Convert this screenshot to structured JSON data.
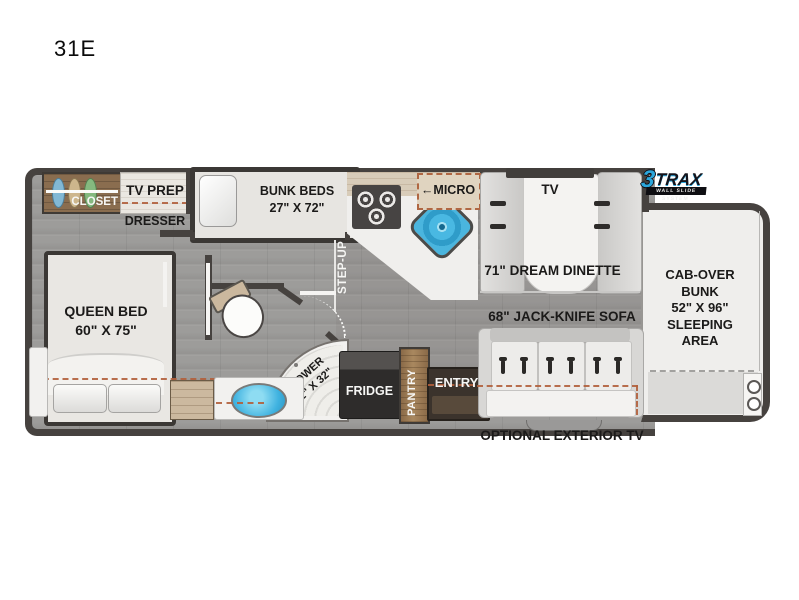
{
  "model": "31E",
  "logo": {
    "number": "3",
    "name": "TRAX",
    "tagline": "WALL SLIDE SYSTEM"
  },
  "labels": {
    "closet": "CLOSET",
    "tv_prep": "TV PREP",
    "dresser": "DRESSER",
    "bunk_line1": "BUNK BEDS",
    "bunk_line2": "27\" X 72\"",
    "micro_arrow": "←",
    "micro": "MICRO",
    "step_up": "STEP-UP",
    "dinette_tv": "TV",
    "dinette": "71\" DREAM DINETTE",
    "cab_over": "CAB-OVER\nBUNK\n52\" X 96\"\nSLEEPING\nAREA",
    "queen_line1": "QUEEN BED",
    "queen_line2": "60\" X 75\"",
    "shower_line1": "SHOWER",
    "shower_line2": "32\" X 32\"",
    "fridge": "FRIDGE",
    "pantry": "PANTRY",
    "entry": "ENTRY",
    "sofa": "68\" JACK-KNIFE SOFA",
    "exterior_tv": "OPTIONAL EXTERIOR TV"
  },
  "colors": {
    "wall": "#46423f",
    "floor": "#9d9c9a",
    "accent_blue": "#3ab0e0",
    "slide_dash": "#b2603c",
    "logo_blue": "#2ba7dc"
  }
}
